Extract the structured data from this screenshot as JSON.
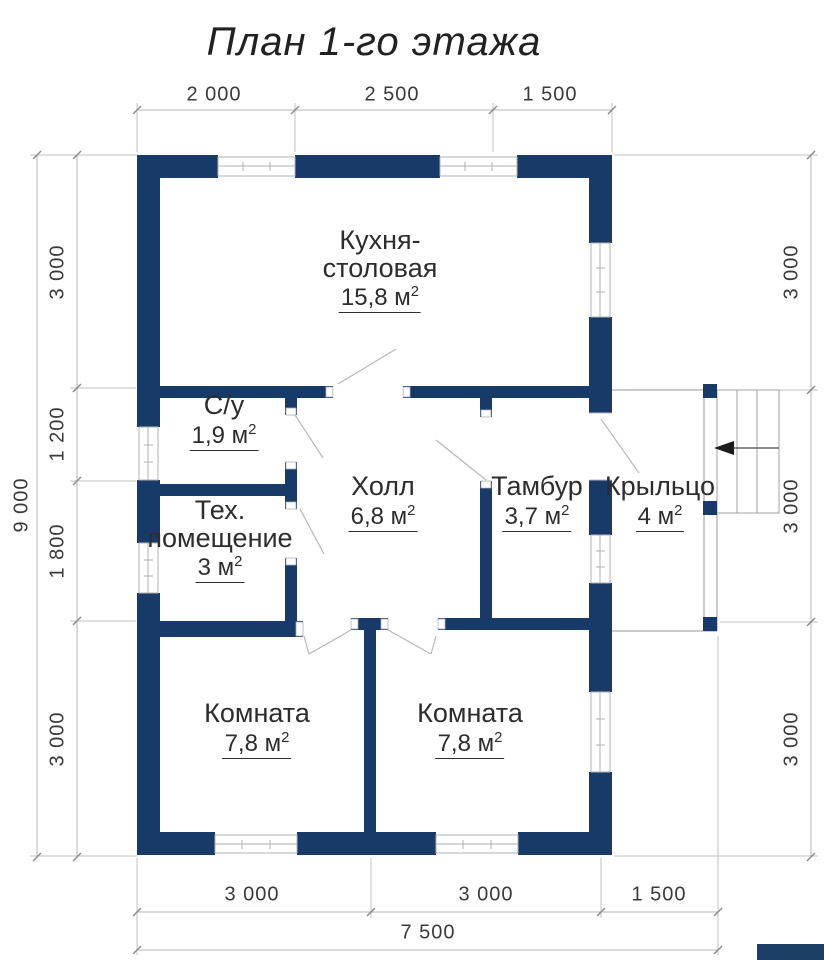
{
  "title": "План 1-го этажа",
  "colors": {
    "wall": "#173a68",
    "dim_line": "#b4b4b4",
    "window_frame": "#b0b0b0",
    "porch_line": "#979797",
    "text": "#2d2d2d",
    "dim_text": "#3a3a3a"
  },
  "icons": {
    "entry_arrow": "arrow-left"
  },
  "rooms": {
    "kitchen": {
      "line1": "Кухня-",
      "line2": "столовая",
      "area": "15,8 м",
      "sup": "2"
    },
    "bathroom": {
      "line1": "С/у",
      "area": "1,9 м",
      "sup": "2"
    },
    "tech": {
      "line1": "Тех.",
      "line2": "помещение",
      "area": "3 м",
      "sup": "2"
    },
    "hall": {
      "line1": "Холл",
      "area": "6,8 м",
      "sup": "2"
    },
    "vestibule": {
      "line1": "Тамбур",
      "area": "3,7 м",
      "sup": "2"
    },
    "porch": {
      "line1": "Крыльцо",
      "area": "4 м",
      "sup": "2"
    },
    "room1": {
      "line1": "Комната",
      "area": "7,8 м",
      "sup": "2"
    },
    "room2": {
      "line1": "Комната",
      "area": "7,8 м",
      "sup": "2"
    }
  },
  "dimensions": {
    "top": {
      "d1": "2 000",
      "d2": "2 500",
      "d3": "1 500"
    },
    "left": {
      "total": "9 000",
      "d1": "3 000",
      "d2": "1 200",
      "d3": "1 800",
      "d4": "3 000"
    },
    "right": {
      "d1": "3 000",
      "d2": "3 000",
      "d3": "3 000"
    },
    "bottom": {
      "d1": "3 000",
      "d2": "3 000",
      "d3": "1 500",
      "total": "7 500"
    }
  }
}
